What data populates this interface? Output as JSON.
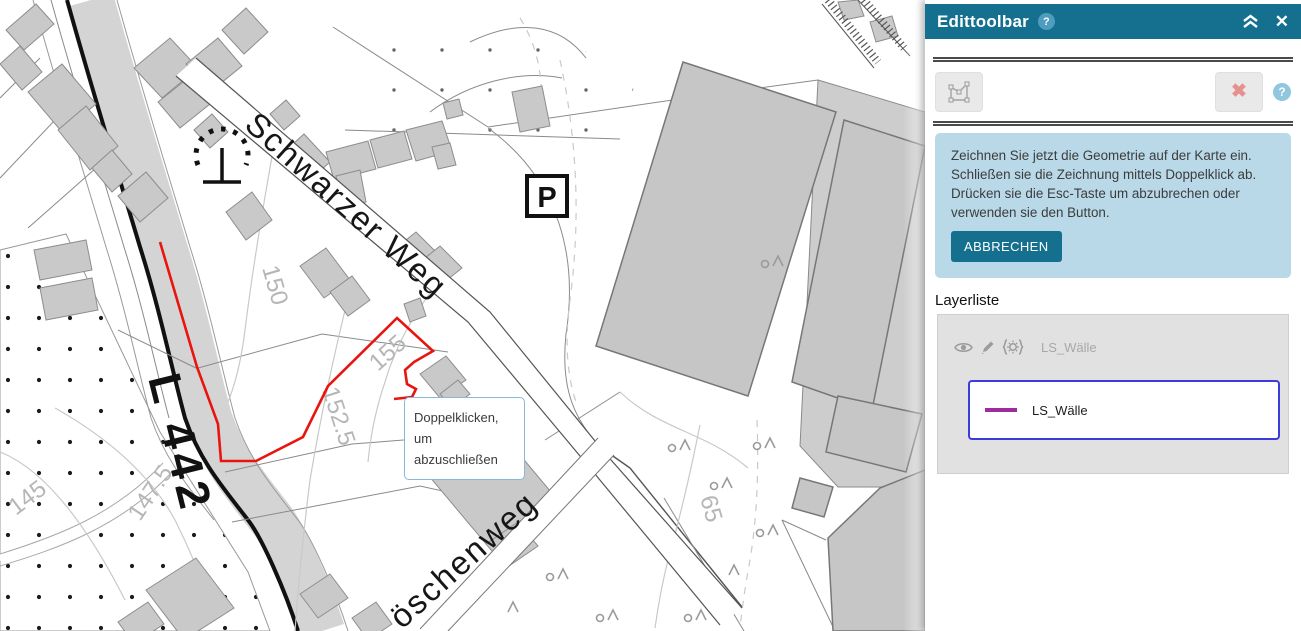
{
  "map": {
    "street_label_1": "Schwarzer Weg",
    "street_label_2": "öschenweg",
    "road_label": "L 442",
    "parking_symbol": "P",
    "contour_labels": {
      "c145": "145",
      "c147": "147.5",
      "c150": "150",
      "c152": "152.5",
      "c155": "155",
      "c65": "65"
    },
    "tooltip": {
      "line1": "Doppelklicken,",
      "line2": "um",
      "line3": "abzuschließen"
    },
    "drawing_color": "#e8150f"
  },
  "panel": {
    "header": {
      "title": "Edittoolbar",
      "help_icon": "?",
      "collapse_icon": "chevron-double-up",
      "close_icon": "✕"
    },
    "toolbar": {
      "draw_polygon_tool": "draw-polygon",
      "cancel_icon": "✖",
      "help_icon": "?"
    },
    "info_box": {
      "line1": "Zeichnen Sie jetzt die Geometrie auf der Karte ein.",
      "line2": "Schließen sie die Zeichnung mittels Doppelklick ab.",
      "line3": "Drücken sie die Esc-Taste um abzubrechen oder",
      "line4": "verwenden sie den Button.",
      "cancel_button": "ABBRECHEN"
    },
    "layer_list": {
      "title": "Layerliste",
      "layer_name": "LS_Wälle",
      "legend_name": "LS_Wälle"
    },
    "colors": {
      "header_teal": "#15708f",
      "info_bg": "#b9d9e8",
      "legend_border": "#3c3cdc",
      "legend_line": "#9b2d9f",
      "cancel_x_red": "#e79090",
      "draw_red": "#e8150f"
    }
  }
}
